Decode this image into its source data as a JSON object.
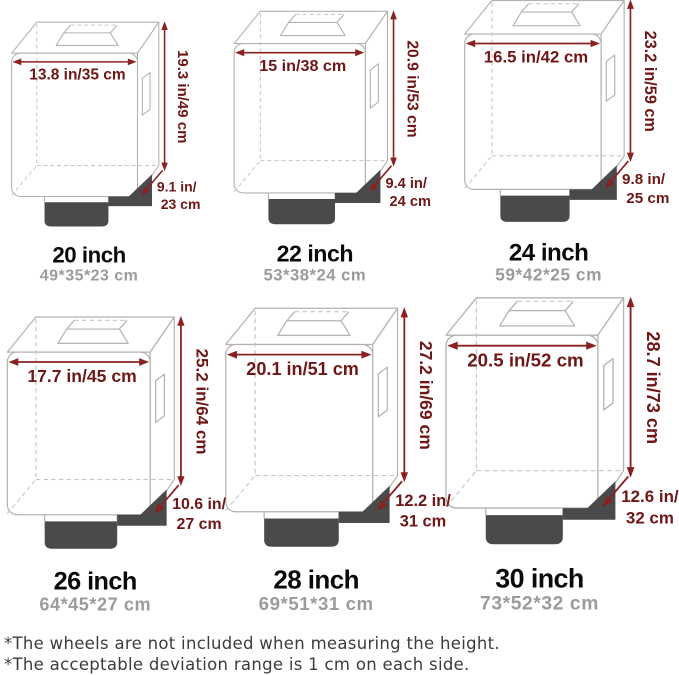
{
  "sizes": [
    {
      "title": "20 inch",
      "subtitle": "49*35*23 cm",
      "width_label": "13.8 in/35 cm",
      "height_label": "19.3 in/49 cm",
      "depth_line1": "9.1 in/",
      "depth_line2": "23 cm"
    },
    {
      "title": "22 inch",
      "subtitle": "53*38*24 cm",
      "width_label": "15 in/38 cm",
      "height_label": "20.9 in/53 cm",
      "depth_line1": "9.4 in/",
      "depth_line2": "24 cm"
    },
    {
      "title": "24 inch",
      "subtitle": "59*42*25 cm",
      "width_label": "16.5 in/42 cm",
      "height_label": "23.2 in/59 cm",
      "depth_line1": "9.8 in/",
      "depth_line2": "25 cm"
    },
    {
      "title": "26 inch",
      "subtitle": "64*45*27 cm",
      "width_label": "17.7 in/45 cm",
      "height_label": "25.2 in/64 cm",
      "depth_line1": "10.6 in/",
      "depth_line2": "27 cm"
    },
    {
      "title": "28 inch",
      "subtitle": "69*51*31 cm",
      "width_label": "20.1 in/51 cm",
      "height_label": "27.2 in/69 cm",
      "depth_line1": "12.2 in/",
      "depth_line2": "31 cm"
    },
    {
      "title": "30 inch",
      "subtitle": "73*52*32 cm",
      "width_label": "20.5 in/52 cm",
      "height_label": "28.7 in/73 cm",
      "depth_line1": "12.6 in/",
      "depth_line2": "32 cm"
    }
  ],
  "footnotes": [
    "*The wheels are not included when measuring the height.",
    "*The acceptable deviation range is 1 cm on each side."
  ],
  "colors": {
    "dimension_text_red": "#6f1616",
    "dimension_arrow_red": "#8a2020",
    "base_dark_gray": "#4a4a4a",
    "wireframe_gray": "#b5b2ae",
    "subtitle_gray": "#9b9b9b",
    "footnote_gray": "#3c3c3c"
  }
}
